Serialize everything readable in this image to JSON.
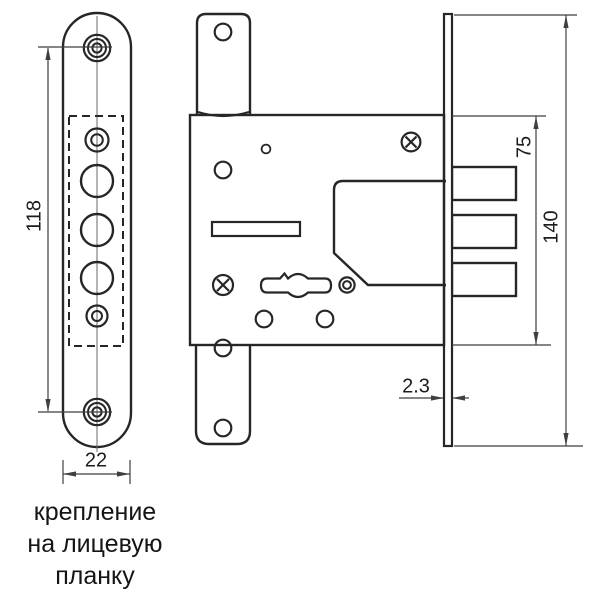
{
  "diagram": {
    "caption_lines": [
      "крепление",
      "на лицевую",
      "планку"
    ],
    "dims": {
      "hole_spacing": "118",
      "plate_width": "22",
      "body_height": "75",
      "strip_height": "140",
      "strip_thickness": "2.3"
    },
    "colors": {
      "line": "#262626",
      "background": "#ffffff"
    }
  }
}
